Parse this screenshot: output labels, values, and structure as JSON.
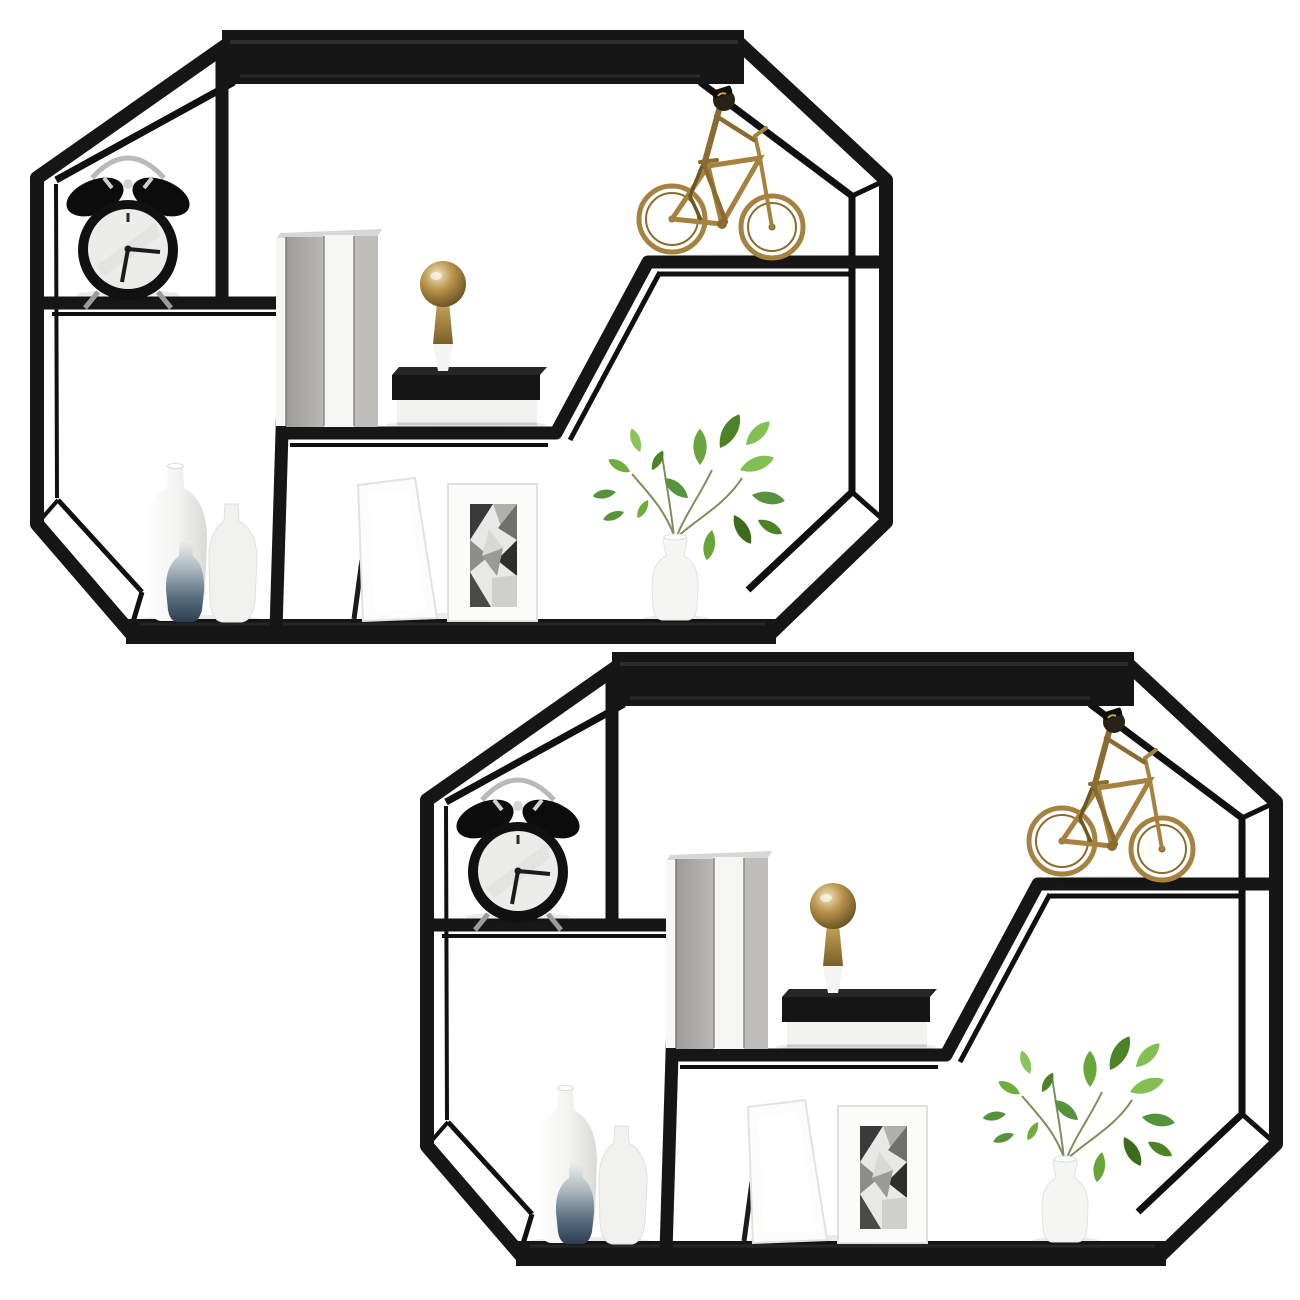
{
  "scene": {
    "type": "product-render",
    "subject": "Set of two identical octagonal matte-black metal wall-mounted display shelves styled with decor objects",
    "background_color": "#ffffff",
    "shelf": {
      "frame_color": "#161616",
      "frame_highlight": "#2e2e2e",
      "instances": [
        {
          "id": "shelf-1",
          "dx": 0,
          "dy": 0
        },
        {
          "id": "shelf-2",
          "dx": 390,
          "dy": 622
        }
      ]
    },
    "decor": {
      "alarm_clock": {
        "label": "black twin-bell alarm clock",
        "body_color": "#111111",
        "face_color": "#ececea",
        "hardware_color": "#b9b9b9"
      },
      "standing_books": {
        "label": "three upright books",
        "colors": [
          "#aeaca8",
          "#f6f6f4",
          "#c0beba"
        ]
      },
      "book_stack": {
        "label": "stacked black and white books",
        "colors": [
          "#151515",
          "#f2f2f0"
        ]
      },
      "finial": {
        "label": "brass ball finial on white cone base",
        "brass_color": "#a5823f",
        "base_color": "#f4f4f2"
      },
      "bicycle": {
        "label": "brass bicycle-with-rider sculpture",
        "color": "#a5823f"
      },
      "vases": {
        "label": "three ceramic bottle vases",
        "colors": [
          "#f4f4f2",
          "#f1f1ef",
          "#3f5468"
        ]
      },
      "frame_blank": {
        "label": "blank white leaning photo frame",
        "color": "#fcfcfb"
      },
      "frame_art": {
        "label": "white photo frame with geometric monochrome artwork",
        "art_colors": [
          "#3a3a3a",
          "#b0b0ae",
          "#6f6f6d",
          "#2e2e2c",
          "#d8d8d6"
        ]
      },
      "plant": {
        "label": "green sprigs in a white bottle vase",
        "leaf_color": "#5a8a2c",
        "vase_color": "#f5f5f3"
      }
    }
  }
}
